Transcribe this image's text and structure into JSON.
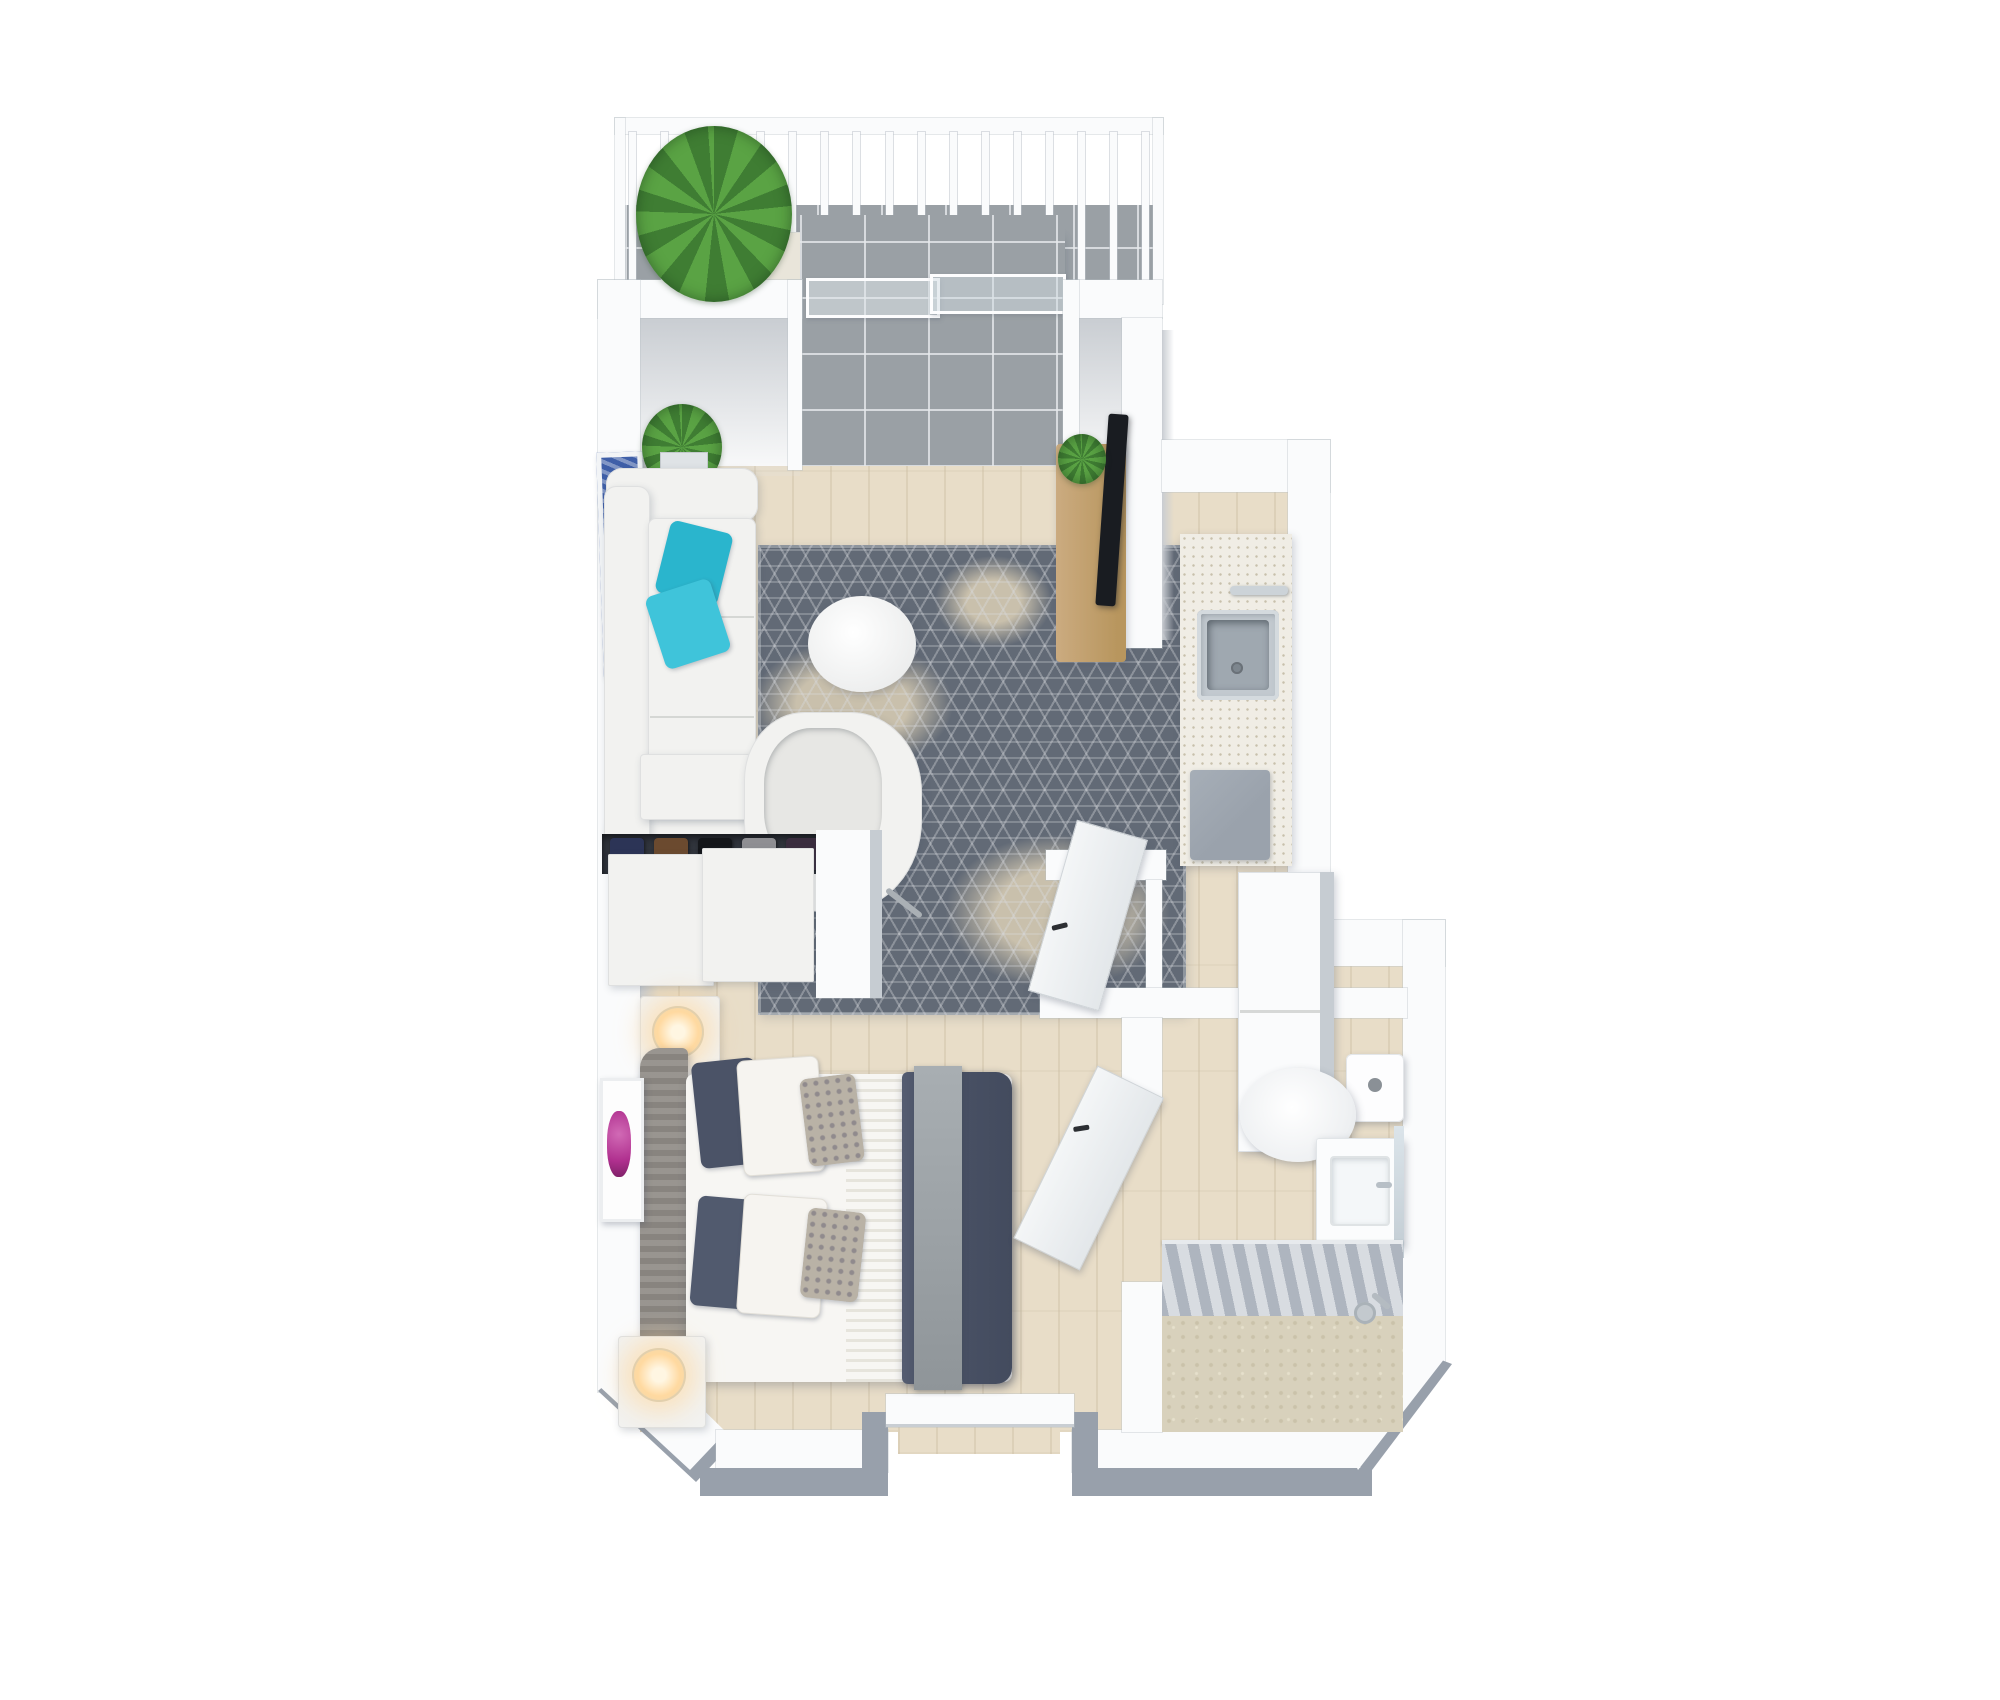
{
  "scene": {
    "kind": "3d-floor-plan-top-view",
    "description": "Photorealistic top-down 3D render of a studio apartment floor plan on a white background. No text labels are rendered in the image.",
    "rooms": [
      {
        "id": "balcony",
        "name": "Balcony",
        "features": [
          "white railing with balusters",
          "gray tile floor",
          "potted plant",
          "two cream lounge chairs",
          "round bistro table",
          "sliding glass door"
        ]
      },
      {
        "id": "living-room",
        "name": "Living room",
        "features": [
          "white sofa with teal accent pillows",
          "blue wall art",
          "snake plant",
          "patterned gray area rug",
          "round white coffee table",
          "white desk console",
          "white tub chair",
          "wood TV console with TV and small plant"
        ]
      },
      {
        "id": "kitchen",
        "name": "Kitchen",
        "features": [
          "speckled white countertop",
          "stainless steel sink with faucet",
          "gray cooktop",
          "tall white cabinets"
        ]
      },
      {
        "id": "closet",
        "name": "Closet",
        "features": [
          "two white sliding doors",
          "hanging clothes visible in gap"
        ]
      },
      {
        "id": "bedroom",
        "name": "Bedroom",
        "features": [
          "bed with gray upholstered headboard",
          "navy duvet",
          "white striped sheet",
          "gray throw",
          "two white nightstands with lit lamps",
          "floral wall art"
        ]
      },
      {
        "id": "bathroom",
        "name": "Bathroom",
        "features": [
          "toilet",
          "white vanity with sink and mirror",
          "gray shower curtain",
          "textured beige tub floor",
          "shower fixture"
        ]
      },
      {
        "id": "entry",
        "name": "Entry",
        "features": [
          "recessed entry alcove in bottom wall",
          "white door header"
        ]
      }
    ]
  },
  "balcony": {
    "baluster_count": 17
  },
  "closet": {
    "visible_items_colors": [
      "#2c3456",
      "#6b4a2f",
      "#14161a",
      "#8f8f93",
      "#3a2d3e",
      "#20242c"
    ]
  },
  "furniture": [
    {
      "room": "balcony",
      "id": "balcony-plant"
    },
    {
      "room": "balcony",
      "id": "balcony-chair-left"
    },
    {
      "room": "balcony",
      "id": "balcony-table"
    },
    {
      "room": "balcony",
      "id": "balcony-chair-right"
    },
    {
      "room": "living-room",
      "id": "sofa"
    },
    {
      "room": "living-room",
      "id": "coffee-table"
    },
    {
      "room": "living-room",
      "id": "area-rug"
    },
    {
      "room": "living-room",
      "id": "desk"
    },
    {
      "room": "living-room",
      "id": "tub-chair"
    },
    {
      "room": "living-room",
      "id": "tv-console"
    },
    {
      "room": "living-room",
      "id": "tv"
    },
    {
      "room": "living-room",
      "id": "wall-art-blue"
    },
    {
      "room": "living-room",
      "id": "snake-plant"
    },
    {
      "room": "kitchen",
      "id": "counter"
    },
    {
      "room": "kitchen",
      "id": "sink"
    },
    {
      "room": "kitchen",
      "id": "cooktop"
    },
    {
      "room": "kitchen",
      "id": "tall-cabinets"
    },
    {
      "room": "closet",
      "id": "sliding-door-1"
    },
    {
      "room": "closet",
      "id": "sliding-door-2"
    },
    {
      "room": "bedroom",
      "id": "bed"
    },
    {
      "room": "bedroom",
      "id": "nightstand-top"
    },
    {
      "room": "bedroom",
      "id": "nightstand-bottom"
    },
    {
      "room": "bedroom",
      "id": "wall-art-floral"
    },
    {
      "room": "bathroom",
      "id": "toilet"
    },
    {
      "room": "bathroom",
      "id": "vanity"
    },
    {
      "room": "bathroom",
      "id": "mirror"
    },
    {
      "room": "bathroom",
      "id": "shower-curtain"
    },
    {
      "room": "bathroom",
      "id": "tub"
    },
    {
      "room": "bathroom",
      "id": "shower-fixture"
    },
    {
      "room": "hallway",
      "id": "hall-door"
    },
    {
      "room": "bathroom",
      "id": "bathroom-door"
    }
  ],
  "palette": {
    "bg": "#ffffff",
    "wallWhite": "#fafbfc",
    "wallFace": "#c9cdd2",
    "wallOuter": "#98a0ab",
    "tile": "#9aa0a5",
    "wood": "#e8ddc8",
    "rugBase": "#626a76",
    "rugPatch": "#c9c0ac",
    "upholstery": "#f2f2f0",
    "teal": "#2ab5cd",
    "tealLight": "#3fc4da",
    "navy": "#4b5367",
    "sheetWhite": "#f7f6f3",
    "throwGray": "#9ca2a6",
    "headboard": "#908c87",
    "woodConsole": "#cbab80",
    "tvBlack": "#191c21",
    "plantGreen": "#3f7d33",
    "plantDark": "#5aa344",
    "lampGlow": "#ffd9a0",
    "steel": "#c2c9cf",
    "steelDark": "#9fa8b0",
    "curtain": "#aeb5bf",
    "curtainLight": "#d8dce1",
    "tubFloor": "#d8d1bc",
    "artBlue": "#3f5fa8",
    "artMagenta": "#b0308f",
    "counter": "#f0ede5",
    "stove": "#9aa2ac",
    "cream": "#e9e5da"
  }
}
